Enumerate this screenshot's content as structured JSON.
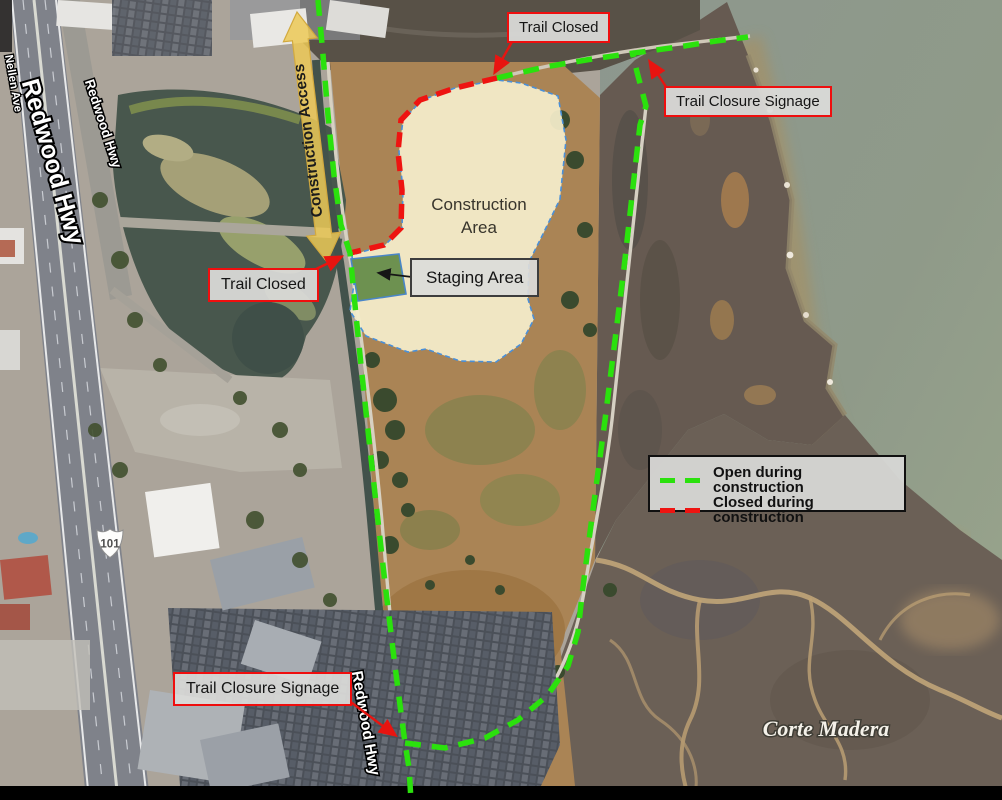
{
  "callouts": {
    "trail_closed": "Trail Closed",
    "trail_closure_signage": "Trail Closure Signage",
    "staging_area": "Staging Area",
    "construction_area": "Construction Area",
    "construction_access": "Construction Access"
  },
  "legend": {
    "open_label": "Open during construction",
    "closed_label": "Closed during construction",
    "open_color": "#2BE10D",
    "closed_color": "#EE1411"
  },
  "roads": {
    "redwood_hwy": "Redwood Hwy",
    "nellen_ave": "Nellen Ave",
    "us_route": "101"
  },
  "places": {
    "corte_madera": "Corte Madera"
  },
  "colors": {
    "construction_fill": "#F5EECB",
    "construction_border": "#4A90D9",
    "staging_fill": "#6D9150",
    "access_arrow": "#ECC957",
    "callout_border": "#EF0E0E",
    "callout_bg": "#DBDBD9"
  }
}
